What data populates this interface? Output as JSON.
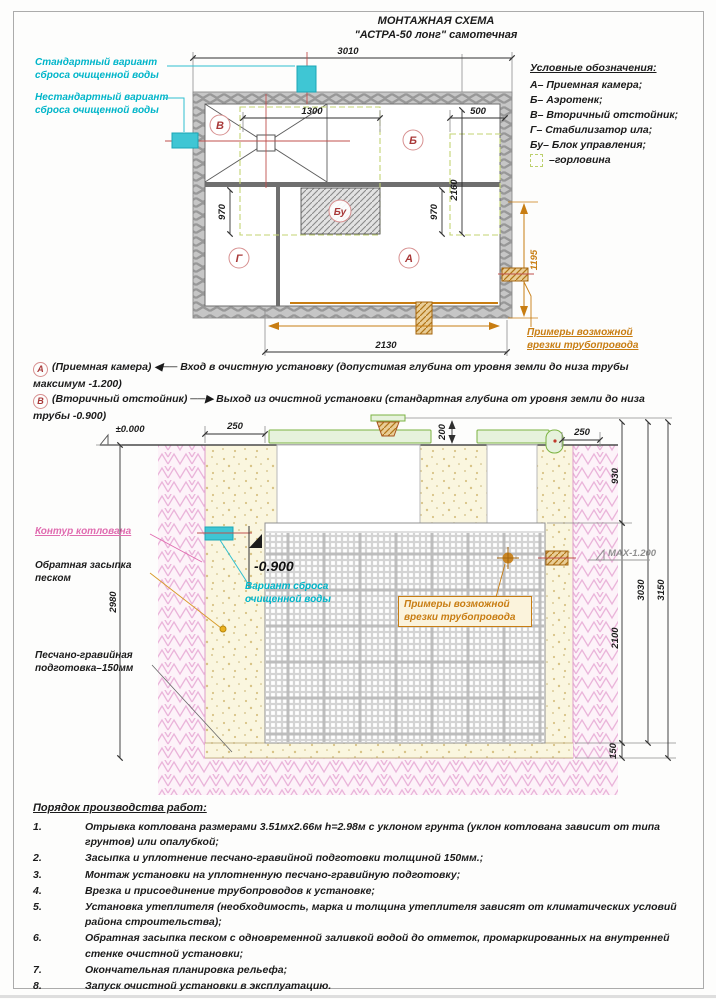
{
  "title": {
    "line1": "МОНТАЖНАЯ СХЕМА",
    "line2": "\"АСТРА-50 лонг\" самотечная"
  },
  "colors": {
    "cyan": "#00b5c9",
    "orange": "#c87d12",
    "pink": "#e06cb0",
    "letter_red": "#a83838",
    "lid_green": "#7cb342"
  },
  "plan": {
    "labels": {
      "standard": "Стандартный вариант сброса очищенной воды",
      "nonstandard": "Нестандартный вариант сброса очищенной воды",
      "pipes": "Примеры возможной врезки трубопровода"
    },
    "legend": {
      "title": "Условные обозначения:",
      "items": [
        "А– Приемная камера;",
        "Б– Аэротенк;",
        "В– Вторичный отстойник;",
        "Г– Стабилизатор ила;",
        "Бу– Блок управления;"
      ],
      "neck": "–горловина"
    },
    "compartments": {
      "A": "А",
      "B": "Б",
      "V": "В",
      "G": "Г",
      "BU": "Бу"
    },
    "dim_3010": "3010",
    "dim_1300": "1300",
    "dim_500": "500",
    "dim_970_left": "970",
    "dim_970_right": "970",
    "dim_2160": "2160",
    "dim_2130": "2130",
    "dim_1195": "1195"
  },
  "notes": [
    {
      "marker": "А",
      "body": "(Приемная камера) ◀── Вход в очистную установку (допустимая глубина от уровня земли до низа трубы максимум -1.200)"
    },
    {
      "marker": "В",
      "body": "(Вторичный отстойник) ──▶ Выход из очистной установки (стандартная глубина от уровня земли до низа трубы -0.900)"
    }
  ],
  "section": {
    "level_zero": "±0.000",
    "level_outlet": "-0.900",
    "level_max": "МАХ-1.200",
    "dim_250l": "250",
    "dim_200": "200",
    "dim_250r": "250",
    "dim_930": "930",
    "dim_2980": "2980",
    "dim_2100": "2100",
    "dim_3030": "3030",
    "dim_3150": "3150",
    "dim_150": "150",
    "labels": {
      "pit": "Контур котлована",
      "backfill": "Обратная засыпка песком",
      "bed": "Песчано-гравийная подготовка–150мм",
      "discharge": "Вариант сброса очищенной воды",
      "pipes": "Примеры возможной врезки трубопровода"
    }
  },
  "procedure": {
    "title": "Порядок производства работ:",
    "items": [
      {
        "n": "1.",
        "text": "Отрывка котлована размерами 3.51мх2.66м h=2.98м с уклоном грунта (уклон котлована зависит от типа грунтов) или опалубкой;"
      },
      {
        "n": "2.",
        "text": "Засыпка и уплотнение песчано-гравийной подготовки толщиной 150мм.;"
      },
      {
        "n": "3.",
        "text": "Монтаж установки на уплотненную песчано-гравийную подготовку;"
      },
      {
        "n": "4.",
        "text": "Врезка и присоединение трубопроводов к установке;"
      },
      {
        "n": "5.",
        "text": "Установка утеплителя (необходимость, марка и толщина утеплителя зависят от климатических условий района строительства);"
      },
      {
        "n": "6.",
        "text": "Обратная засыпка песком с одновременной заливкой водой до отметок, промаркированных на внутренней стенке очистной установки;"
      },
      {
        "n": "7.",
        "text": "Окончательная планировка рельефа;"
      },
      {
        "n": "8.",
        "text": "Запуск очистной установки в эксплуатацию."
      }
    ]
  }
}
